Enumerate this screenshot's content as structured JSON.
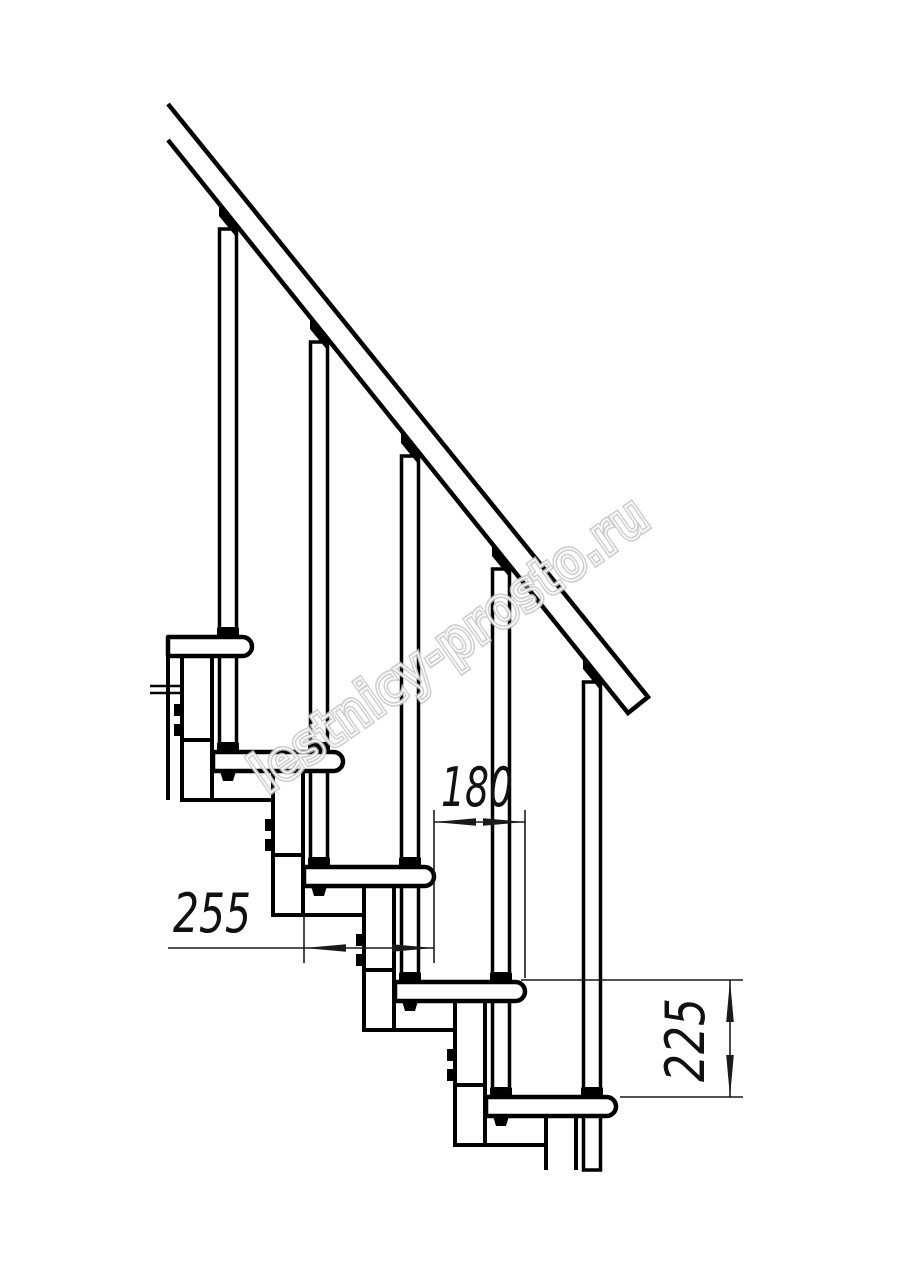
{
  "drawing": {
    "watermark": {
      "text": "lestnicy-prosto.ru",
      "color": "#c5c5c5"
    },
    "dimensions": [
      {
        "id": "step-run-horizontal",
        "label": "180"
      },
      {
        "id": "tread-depth",
        "label": "255"
      },
      {
        "id": "step-rise",
        "label": "225"
      }
    ],
    "structure": {
      "treads_visible": 5,
      "balusters_visible": 5,
      "spine_modules_visible": 5,
      "has_handrail": true
    },
    "colors": {
      "line": "#000000",
      "dimension": "#1a1a1a",
      "background": "#ffffff"
    }
  }
}
